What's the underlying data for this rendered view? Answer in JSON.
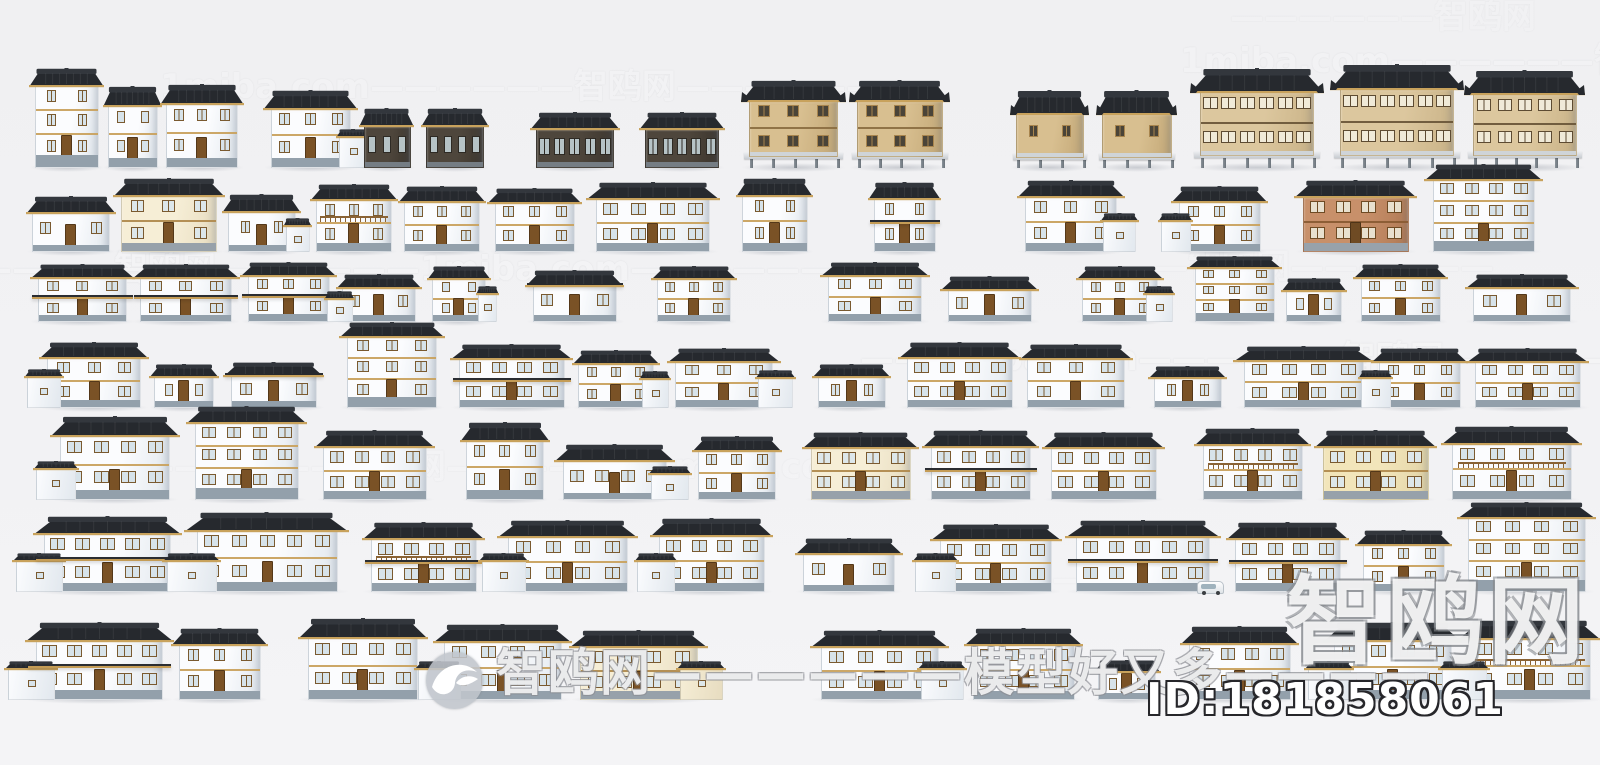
{
  "meta": {
    "description": "Preview sheet of Chinese rural house 3D models arranged in 7 rows",
    "background": "#f2f2f4",
    "roof_dark": "#26292e",
    "roof_ridge": "#33373d",
    "roof_eave": "#c8a25c"
  },
  "watermarks": {
    "id_label": "ID:181858061",
    "corner_text": "智鸥网",
    "center_text": "智鸥网——————模型好又多————",
    "logo_icon": "gull-logo",
    "tiled": [
      {
        "x": 160,
        "y": 70,
        "t": "1miba.com——————智鸥网——————",
        "s": 34,
        "o": 0.16
      },
      {
        "x": 1180,
        "y": 44,
        "t": "1miba.com——————智鸥网—",
        "s": 34,
        "o": 0.17
      },
      {
        "x": 1230,
        "y": 0,
        "t": "——————智鸥网",
        "s": 34,
        "o": 0.12
      },
      {
        "x": -90,
        "y": 252,
        "t": "——————智鸥网——————1miba.com——————",
        "s": 34,
        "o": 0.17
      },
      {
        "x": 1120,
        "y": 250,
        "t": "——智鸥网——————",
        "s": 34,
        "o": 0.12
      },
      {
        "x": 860,
        "y": 342,
        "t": "——1miba.com——————智鸥网——————",
        "s": 34,
        "o": 0.17
      },
      {
        "x": 140,
        "y": 450,
        "t": "——————智鸥网——————1miba.com",
        "s": 34,
        "o": 0.13
      },
      {
        "x": 950,
        "y": 562,
        "t": "——————",
        "s": 34,
        "o": 0.1
      }
    ]
  },
  "palettes": {
    "white": {
      "body": "#fbfcfe",
      "shade": "#e2e8ee",
      "win": "#d7e3ea",
      "frame": "#7a5a30",
      "base": "#93a0ab",
      "trim": "#c9a25f",
      "door": "#7a5226"
    },
    "cream": {
      "body": "#f6eed6",
      "shade": "#e7dcc0",
      "win": "#dde7ea",
      "frame": "#7a5a30",
      "base": "#97a1aa",
      "trim": "#b08a4e",
      "door": "#7a5226"
    },
    "yellow": {
      "body": "#f2e5ba",
      "shade": "#e2d4a6",
      "win": "#dde7ea",
      "frame": "#7a5a30",
      "base": "#97a1aa",
      "trim": "#b08a4e",
      "door": "#7a5226"
    },
    "brick": {
      "body": "#c8906a",
      "shade": "#b07a55",
      "win": "#e8e0ce",
      "frame": "#6f4b24",
      "base": "#98a2ab",
      "trim": "#8a5c34",
      "door": "#6f4b24"
    },
    "wood": {
      "body": "#4e463c",
      "shade": "#3c352d",
      "win": "#b6c3c6",
      "frame": "#2e2a24",
      "base": "#757d84",
      "trim": "#c8a567",
      "door": "#3c352d"
    },
    "gold": {
      "body": "#d8bf90",
      "shade": "#c3a877",
      "win": "#4a4438",
      "frame": "#a8854e",
      "base": "#cfd4d8",
      "trim": "#8c6f42",
      "door": "#8c6f42"
    },
    "timber": {
      "body": "#dcc79e",
      "shade": "#c9b287",
      "win": "#f0ead8",
      "frame": "#5d4b32",
      "base": "#cfd4d8",
      "trim": "#6b573a",
      "door": "#6b573a"
    }
  },
  "rows": [
    {
      "baseline": 168,
      "buildings": [
        {
          "x": 33,
          "w": 68,
          "h": 100,
          "s": 3
        },
        {
          "x": 106,
          "w": 54,
          "h": 82,
          "s": 2
        },
        {
          "x": 164,
          "w": 76,
          "h": 84,
          "s": 2
        },
        {
          "x": 268,
          "w": 86,
          "h": 78,
          "s": 2,
          "a": "r"
        },
        {
          "x": 362,
          "w": 50,
          "h": 60,
          "s": 1,
          "b": "wood",
          "nd": 1
        },
        {
          "x": 424,
          "w": 62,
          "h": 60,
          "s": 1,
          "b": "wood",
          "nd": 1
        },
        {
          "x": 534,
          "w": 82,
          "h": 56,
          "s": 1,
          "b": "wood",
          "nd": 1
        },
        {
          "x": 643,
          "w": 78,
          "h": 56,
          "s": 1,
          "b": "wood",
          "nd": 1
        },
        {
          "x": 746,
          "w": 95,
          "h": 88,
          "s": 2,
          "b": "gold",
          "st": 1,
          "t": "orn",
          "nd": 1
        },
        {
          "x": 854,
          "w": 92,
          "h": 88,
          "s": 2,
          "b": "gold",
          "st": 1,
          "t": "orn",
          "nd": 1
        },
        {
          "x": 1014,
          "w": 72,
          "h": 78,
          "s": 1,
          "b": "gold",
          "st": 1,
          "t": "orn",
          "nd": 1
        },
        {
          "x": 1100,
          "w": 74,
          "h": 78,
          "s": 1,
          "b": "gold",
          "st": 1,
          "t": "orn",
          "nd": 1
        },
        {
          "x": 1196,
          "w": 122,
          "h": 100,
          "s": 2,
          "b": "timber",
          "st": 1,
          "t": "orn",
          "nd": 1
        },
        {
          "x": 1336,
          "w": 122,
          "h": 104,
          "s": 2,
          "b": "timber",
          "st": 1,
          "t": "orn",
          "nd": 1
        },
        {
          "x": 1470,
          "w": 110,
          "h": 98,
          "s": 2,
          "b": "timber",
          "st": 1,
          "t": "orn",
          "nd": 1
        }
      ]
    },
    {
      "baseline": 252,
      "buildings": [
        {
          "x": 30,
          "w": 82,
          "h": 56,
          "s": 1
        },
        {
          "x": 118,
          "w": 102,
          "h": 74,
          "s": 2,
          "b": "cream"
        },
        {
          "x": 226,
          "w": 72,
          "h": 58,
          "s": 1,
          "a": "r"
        },
        {
          "x": 314,
          "w": 80,
          "h": 68,
          "s": 2,
          "bal": 1
        },
        {
          "x": 402,
          "w": 80,
          "h": 66,
          "s": 2
        },
        {
          "x": 492,
          "w": 86,
          "h": 64,
          "s": 2
        },
        {
          "x": 592,
          "w": 122,
          "h": 70,
          "s": 2
        },
        {
          "x": 740,
          "w": 70,
          "h": 74,
          "s": 2
        },
        {
          "x": 872,
          "w": 66,
          "h": 70,
          "s": 2,
          "p": 1
        },
        {
          "x": 1022,
          "w": 98,
          "h": 72,
          "s": 2,
          "a": "r"
        },
        {
          "x": 1176,
          "w": 88,
          "h": 66,
          "s": 2,
          "a": "l"
        },
        {
          "x": 1300,
          "w": 112,
          "h": 72,
          "s": 2,
          "b": "brick"
        },
        {
          "x": 1430,
          "w": 108,
          "h": 88,
          "s": 3
        }
      ]
    },
    {
      "baseline": 322,
      "buildings": [
        {
          "x": 35,
          "w": 95,
          "h": 58,
          "s": 2,
          "p": 1
        },
        {
          "x": 137,
          "w": 98,
          "h": 58,
          "s": 2,
          "p": 1
        },
        {
          "x": 245,
          "w": 88,
          "h": 60,
          "s": 2,
          "p": 1
        },
        {
          "x": 340,
          "w": 78,
          "h": 48,
          "s": 1,
          "a": "l"
        },
        {
          "x": 430,
          "w": 58,
          "h": 56,
          "s": 2,
          "a": "r"
        },
        {
          "x": 530,
          "w": 90,
          "h": 52,
          "s": 1,
          "p": 1
        },
        {
          "x": 655,
          "w": 78,
          "h": 56,
          "s": 2
        },
        {
          "x": 825,
          "w": 100,
          "h": 60,
          "s": 2
        },
        {
          "x": 945,
          "w": 90,
          "h": 46,
          "s": 1
        },
        {
          "x": 1080,
          "w": 80,
          "h": 56,
          "s": 2,
          "a": "r"
        },
        {
          "x": 1192,
          "w": 86,
          "h": 66,
          "s": 3
        },
        {
          "x": 1284,
          "w": 60,
          "h": 44,
          "s": 1
        },
        {
          "x": 1358,
          "w": 86,
          "h": 58,
          "s": 2
        },
        {
          "x": 1470,
          "w": 104,
          "h": 48,
          "s": 1
        }
      ]
    },
    {
      "baseline": 408,
      "buildings": [
        {
          "x": 44,
          "w": 100,
          "h": 66,
          "s": 2,
          "a": "l"
        },
        {
          "x": 152,
          "w": 64,
          "h": 44,
          "s": 1
        },
        {
          "x": 228,
          "w": 92,
          "h": 46,
          "s": 1,
          "p": 1
        },
        {
          "x": 344,
          "w": 96,
          "h": 86,
          "s": 3
        },
        {
          "x": 456,
          "w": 112,
          "h": 64,
          "s": 2,
          "p": 1
        },
        {
          "x": 576,
          "w": 80,
          "h": 58,
          "s": 2,
          "a": "r"
        },
        {
          "x": 672,
          "w": 104,
          "h": 60,
          "s": 2,
          "a": "r"
        },
        {
          "x": 816,
          "w": 72,
          "h": 44,
          "s": 1
        },
        {
          "x": 904,
          "w": 112,
          "h": 66,
          "s": 2
        },
        {
          "x": 1024,
          "w": 104,
          "h": 64,
          "s": 2
        },
        {
          "x": 1152,
          "w": 72,
          "h": 42,
          "s": 1
        },
        {
          "x": 1240,
          "w": 128,
          "h": 62,
          "s": 2
        },
        {
          "x": 1376,
          "w": 88,
          "h": 60,
          "s": 2,
          "a": "l"
        },
        {
          "x": 1472,
          "w": 112,
          "h": 60,
          "s": 2
        }
      ]
    },
    {
      "baseline": 500,
      "buildings": [
        {
          "x": 56,
          "w": 118,
          "h": 84,
          "s": 2,
          "a": "l"
        },
        {
          "x": 192,
          "w": 110,
          "h": 94,
          "s": 3
        },
        {
          "x": 320,
          "w": 110,
          "h": 70,
          "s": 2
        },
        {
          "x": 464,
          "w": 82,
          "h": 78,
          "s": 2
        },
        {
          "x": 560,
          "w": 110,
          "h": 56,
          "s": 1,
          "a": "r"
        },
        {
          "x": 696,
          "w": 82,
          "h": 64,
          "s": 2
        },
        {
          "x": 808,
          "w": 106,
          "h": 68,
          "s": 2,
          "b": "cream"
        },
        {
          "x": 928,
          "w": 106,
          "h": 70,
          "s": 2,
          "p": 1
        },
        {
          "x": 1048,
          "w": 112,
          "h": 68,
          "s": 2
        },
        {
          "x": 1200,
          "w": 106,
          "h": 72,
          "s": 2,
          "bal": 1
        },
        {
          "x": 1320,
          "w": 112,
          "h": 70,
          "s": 2,
          "b": "yellow"
        },
        {
          "x": 1448,
          "w": 128,
          "h": 74,
          "s": 2,
          "bal": 1
        }
      ]
    },
    {
      "baseline": 592,
      "buildings": [
        {
          "x": 40,
          "w": 135,
          "h": 76,
          "s": 2,
          "p": 1,
          "a": "l"
        },
        {
          "x": 192,
          "w": 150,
          "h": 80,
          "s": 2,
          "a": "l"
        },
        {
          "x": 368,
          "w": 112,
          "h": 70,
          "s": 2,
          "p": 1,
          "bal": 1
        },
        {
          "x": 504,
          "w": 128,
          "h": 72,
          "s": 2,
          "a": "l"
        },
        {
          "x": 656,
          "w": 112,
          "h": 74,
          "s": 2,
          "a": "l"
        },
        {
          "x": 800,
          "w": 98,
          "h": 54,
          "s": 1
        },
        {
          "x": 936,
          "w": 120,
          "h": 68,
          "s": 2,
          "a": "l"
        },
        {
          "x": 1072,
          "w": 142,
          "h": 72,
          "s": 2,
          "p": 1,
          "car": 1
        },
        {
          "x": 1232,
          "w": 112,
          "h": 70,
          "s": 2,
          "p": 1
        },
        {
          "x": 1360,
          "w": 88,
          "h": 62,
          "s": 2
        },
        {
          "x": 1464,
          "w": 126,
          "h": 90,
          "s": 3
        }
      ]
    },
    {
      "baseline": 700,
      "buildings": [
        {
          "x": 32,
          "w": 135,
          "h": 78,
          "s": 2,
          "p": 1,
          "a": "l"
        },
        {
          "x": 176,
          "w": 88,
          "h": 72,
          "s": 2
        },
        {
          "x": 304,
          "w": 118,
          "h": 82,
          "s": 2
        },
        {
          "x": 440,
          "w": 126,
          "h": 76,
          "s": 2,
          "a": "l"
        },
        {
          "x": 576,
          "w": 126,
          "h": 70,
          "s": 2,
          "b": "cream",
          "a": "r"
        },
        {
          "x": 817,
          "w": 126,
          "h": 70,
          "s": 2,
          "a": "r"
        },
        {
          "x": 970,
          "w": 108,
          "h": 72,
          "s": 2
        },
        {
          "x": 1096,
          "w": 62,
          "h": 40,
          "s": 1
        },
        {
          "x": 1186,
          "w": 108,
          "h": 74,
          "s": 2
        },
        {
          "x": 1330,
          "w": 126,
          "h": 78,
          "s": 2,
          "a": "l"
        },
        {
          "x": 1465,
          "w": 130,
          "h": 80,
          "s": 2,
          "a": "l",
          "bal": 1
        }
      ]
    }
  ]
}
